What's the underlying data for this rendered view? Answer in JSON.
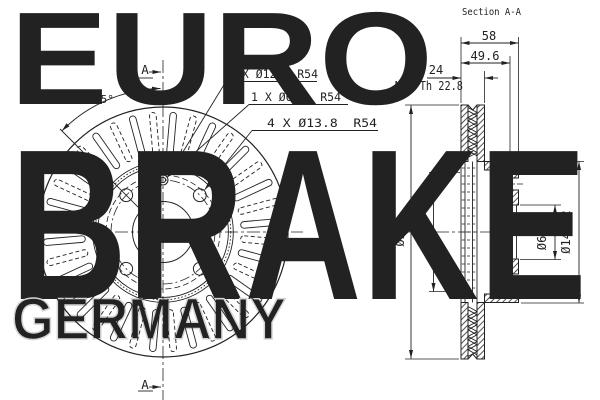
{
  "watermark": {
    "top": "EURO",
    "middle": "BRAKE",
    "bottom": "GERMANY"
  },
  "front_view": {
    "section_marker_top": "A",
    "section_marker_bottom": "A",
    "angle_label": "45°",
    "callouts": {
      "pilot_hole_outer": "1 X Ø12.6 R54",
      "pilot_hole_inner": "1 X Ø6.5  R54",
      "bolt_holes": "4 X Ø13.8  R54"
    }
  },
  "section_view": {
    "title": "Section A-A",
    "dims": {
      "overall_width": "58",
      "hat_depth": "49.6",
      "disc_thickness": "24",
      "min_thickness": "Min Th 22.8",
      "outer_diameter": "Ø260",
      "vent_inner_diameter": "Ø136",
      "center_bore": "Ø63.7",
      "hat_outer_diameter": "Ø146.2"
    }
  },
  "colors": {
    "line": "#222222",
    "watermark": "#d8d8d8",
    "background": "#ffffff"
  }
}
